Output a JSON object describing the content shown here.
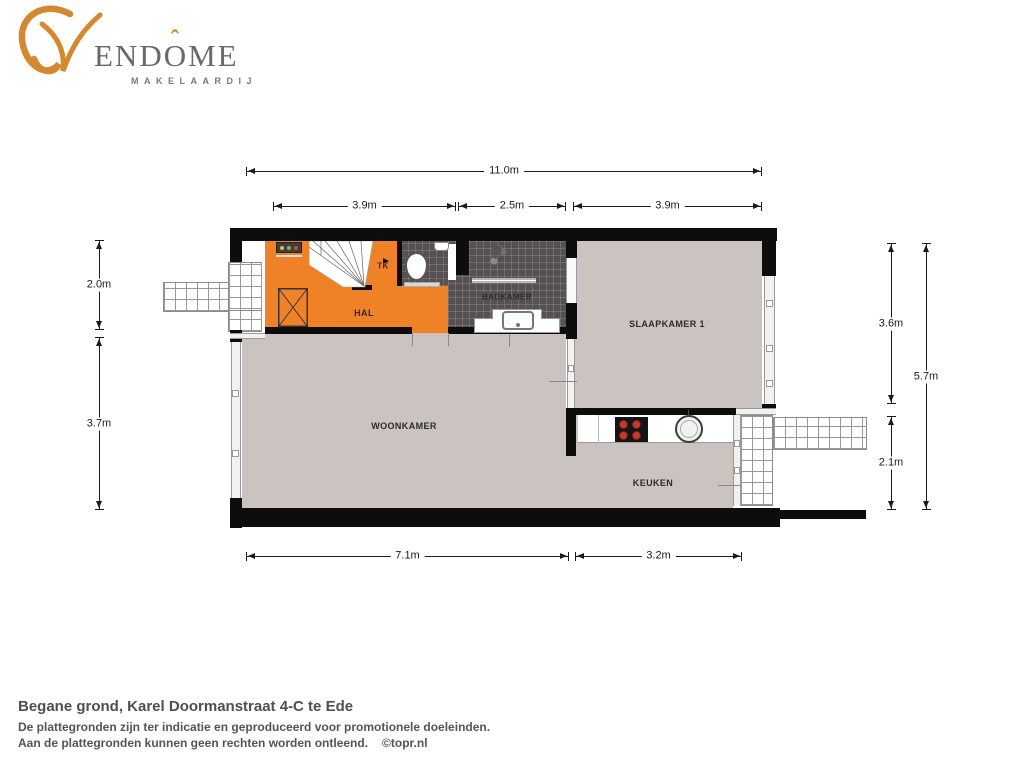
{
  "logo": {
    "p1": "END",
    "o": "O",
    "accent": "ˆ",
    "p2": "ME",
    "subtitle": "MAKELAARDIJ"
  },
  "rooms": {
    "hal": "HAL",
    "tk": "TK",
    "badkamer": "BADKAMER",
    "slaapkamer1": "SLAAPKAMER 1",
    "woonkamer": "WOONKAMER",
    "keuken": "KEUKEN"
  },
  "dimensions": {
    "top_total": "11.0m",
    "top_seg1": "3.9m",
    "top_seg2": "2.5m",
    "top_seg3": "3.9m",
    "left_upper": "2.0m",
    "left_lower": "3.7m",
    "right_upper": "3.6m",
    "right_lower": "2.1m",
    "right_total": "5.7m",
    "bottom_seg1": "7.1m",
    "bottom_seg2": "3.2m"
  },
  "caption": {
    "title": "Begane grond, Karel Doormanstraat 4-C te Ede",
    "line1": "De plattegronden zijn ter indicatie en geproduceerd voor promotionele doeleinden.",
    "line2": "Aan de plattegronden kunnen geen rechten worden ontleend.",
    "credit": "©topr.nl"
  },
  "colors": {
    "hal_orange": "#EF8226",
    "floor_beige": "#CBC3C0",
    "tile_dark": "#575052",
    "wall_black": "#0D0D0D",
    "logo_orange": "#D4882F",
    "logo_gray": "#696969",
    "burner_red": "#C43A2E"
  }
}
